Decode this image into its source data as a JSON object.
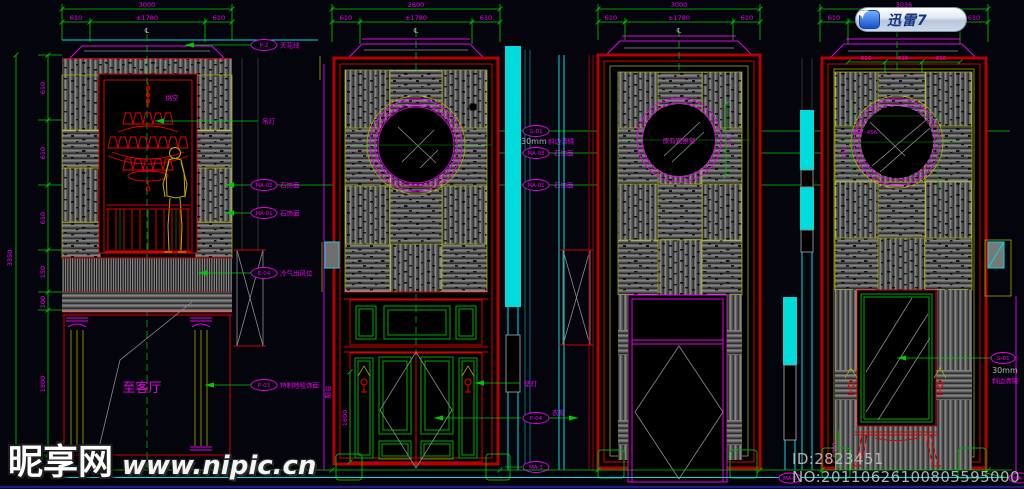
{
  "overlay": {
    "xunlei_label": "迅雷7"
  },
  "watermark": {
    "brand": "昵享网",
    "url": "www.nipic.cn"
  },
  "footer": {
    "id_no": "ID:2823451 NO:20110626100805595000",
    "tag_left": "MA-3",
    "tag_right": "MA-3"
  },
  "symbols": {
    "centerline": "℄"
  },
  "elevation1": {
    "dims": {
      "total": "3000",
      "left": "610",
      "center": "±1780",
      "right": "610",
      "height_total": "3350",
      "segs": [
        "610",
        "610",
        "610",
        "150",
        "100",
        "1800"
      ]
    },
    "notes": {
      "void": "挑空",
      "ceiling_tag": "P-2",
      "ceiling": "天花线",
      "chandelier": "吊灯",
      "stone_a_tag": "MA-02",
      "stone_a": "石饰面",
      "stone_b_tag": "MA-01",
      "stone_b": "石饰面",
      "ac_tag": "E-04",
      "ac": "冷气出风位",
      "carpet_tag": "P-03",
      "carpet": "特制地毯饰面",
      "destination": "至客厅"
    }
  },
  "elevation2": {
    "dims": {
      "total": "2600",
      "left": "610",
      "center": "±1780",
      "right": "610",
      "lamp_height": "1800"
    },
    "notes": {
      "mirror_tag": "G-01",
      "mirror_size": "30mm",
      "mirror": "斜边清镜",
      "stone_c_tag": "MA-03",
      "stone_c": "石饰面",
      "stone_b_tag": "MA-01",
      "stone_b": "石饰面",
      "wall_lamp": "壁灯",
      "door_tag": "P-04",
      "door": "衣帽",
      "plant_tag": "MA-3",
      "side_text": "阳台"
    }
  },
  "elevation3": {
    "dims": {
      "total": "3000",
      "left": "610",
      "center": "±1780",
      "right": "610",
      "window_width": "610"
    },
    "notes": {
      "window": "原有观察窗"
    }
  },
  "elevation4": {
    "dims": {
      "total": "3036",
      "left": "610",
      "right": "610",
      "sub": [
        "610",
        "610",
        "610"
      ],
      "circle_a": "200",
      "circle_b": "456",
      "circle_h": "610",
      "bottom": "300"
    },
    "notes": {
      "mirror_tag": "G-01",
      "mirror_size": "30mm",
      "mirror": "斜边清镜"
    }
  }
}
